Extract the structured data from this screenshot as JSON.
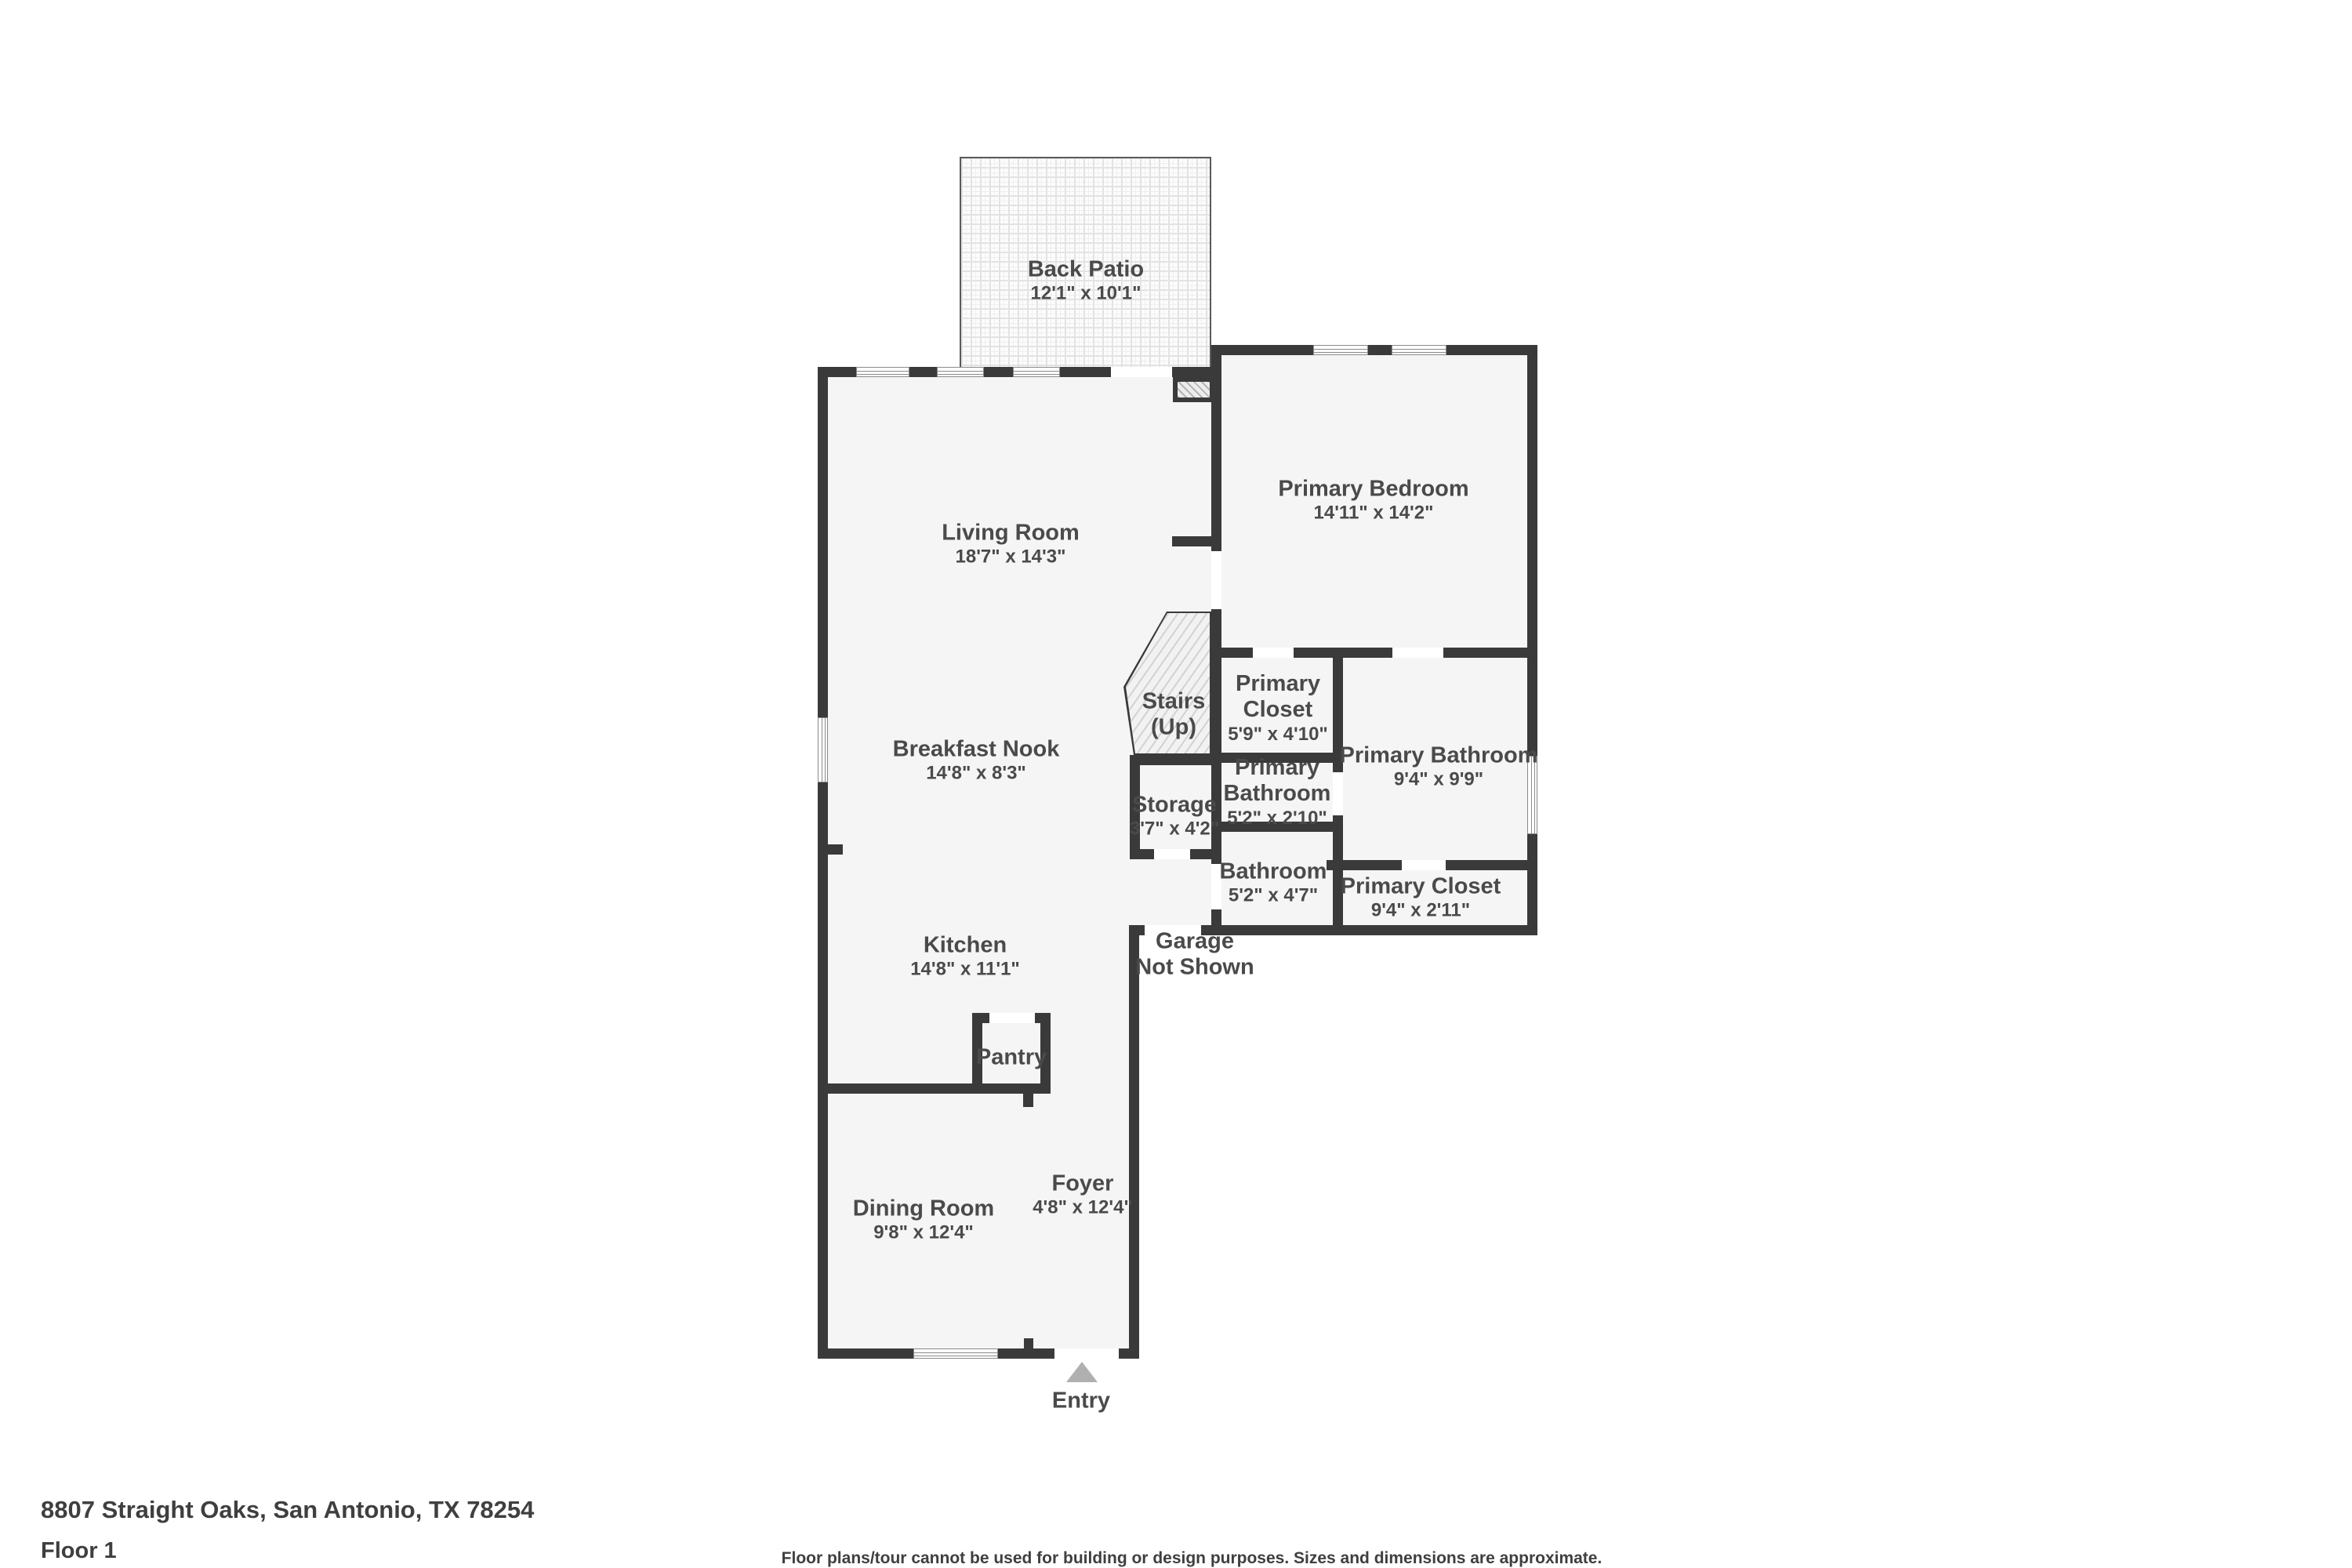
{
  "colors": {
    "wall": "#3a3a3a",
    "room_fill": "#f5f5f5",
    "label_text": "#4a4a4a",
    "window_frame": "#8a8a8a",
    "entry_arrow": "#b0b0b0"
  },
  "rooms": {
    "back_patio": {
      "name": "Back Patio",
      "dims": "12'1\" x 10'1\""
    },
    "living_room": {
      "name": "Living Room",
      "dims": "18'7\" x 14'3\""
    },
    "primary_bedroom": {
      "name": "Primary Bedroom",
      "dims": "14'11\" x 14'2\""
    },
    "stairs": {
      "name": "Stairs",
      "dims": "(Up)"
    },
    "primary_closet_upper": {
      "name": "Primary Closet",
      "dims": "5'9\" x 4'10\""
    },
    "primary_bathroom_large": {
      "name": "Primary Bathroom",
      "dims": "9'4\" x 9'9\""
    },
    "breakfast_nook": {
      "name": "Breakfast Nook",
      "dims": "14'8\" x 8'3\""
    },
    "storage": {
      "name": "Storage",
      "dims": "3'7\" x 4'2\""
    },
    "primary_bathroom_small": {
      "name": "Primary Bathroom",
      "dims": "5'2\" x 2'10\""
    },
    "bathroom": {
      "name": "Bathroom",
      "dims": "5'2\" x 4'7\""
    },
    "primary_closet_lower": {
      "name": "Primary Closet",
      "dims": "9'4\" x 2'11\""
    },
    "kitchen": {
      "name": "Kitchen",
      "dims": "14'8\" x 11'1\""
    },
    "garage": {
      "name": "Garage",
      "dims": "Not Shown"
    },
    "pantry": {
      "name": "Pantry",
      "dims": ""
    },
    "foyer": {
      "name": "Foyer",
      "dims": "4'8\" x 12'4\""
    },
    "dining_room": {
      "name": "Dining Room",
      "dims": "9'8\" x 12'4\""
    },
    "entry": {
      "name": "Entry",
      "dims": ""
    }
  },
  "footer": {
    "address": "8807 Straight Oaks, San Antonio, TX 78254",
    "floor": "Floor 1",
    "disclaimer": "Floor plans/tour cannot be used for building or design purposes. Sizes and dimensions are approximate."
  }
}
